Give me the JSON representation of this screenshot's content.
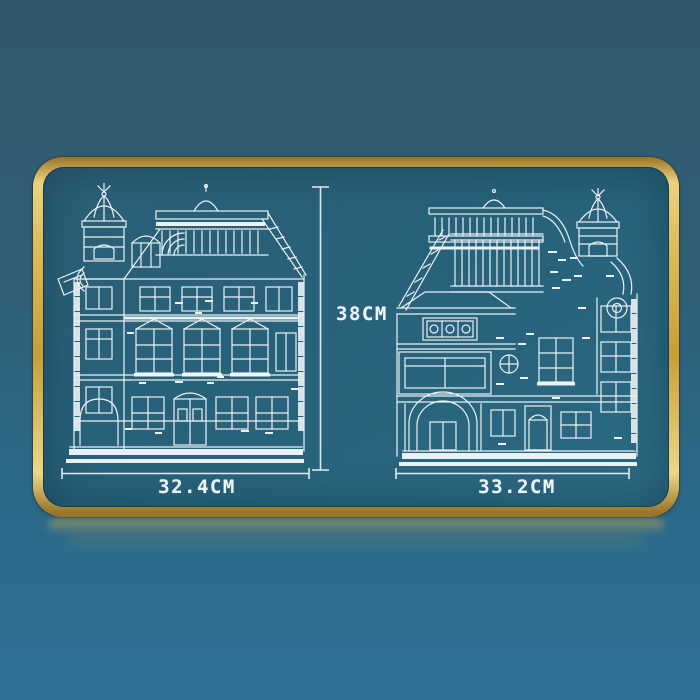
{
  "scene": {
    "description": "gold-framed blueprint plaque showing front and rear elevations of a brick-built modular building with dimension callouts",
    "labels": {
      "height": "38CM",
      "left_width": "32.4CM",
      "right_width": "33.2CM"
    },
    "drawings": {
      "left": "building-front-elevation-blueprint",
      "right": "building-rear-elevation-blueprint"
    },
    "colors": {
      "background_top": "#30586c",
      "background_bottom": "#2e7095",
      "panel_teal": "#27617a",
      "frame_gold": "#dcb855",
      "blueprint_line": "#f4f9fb",
      "dimension_text": "#edf4f7"
    }
  }
}
